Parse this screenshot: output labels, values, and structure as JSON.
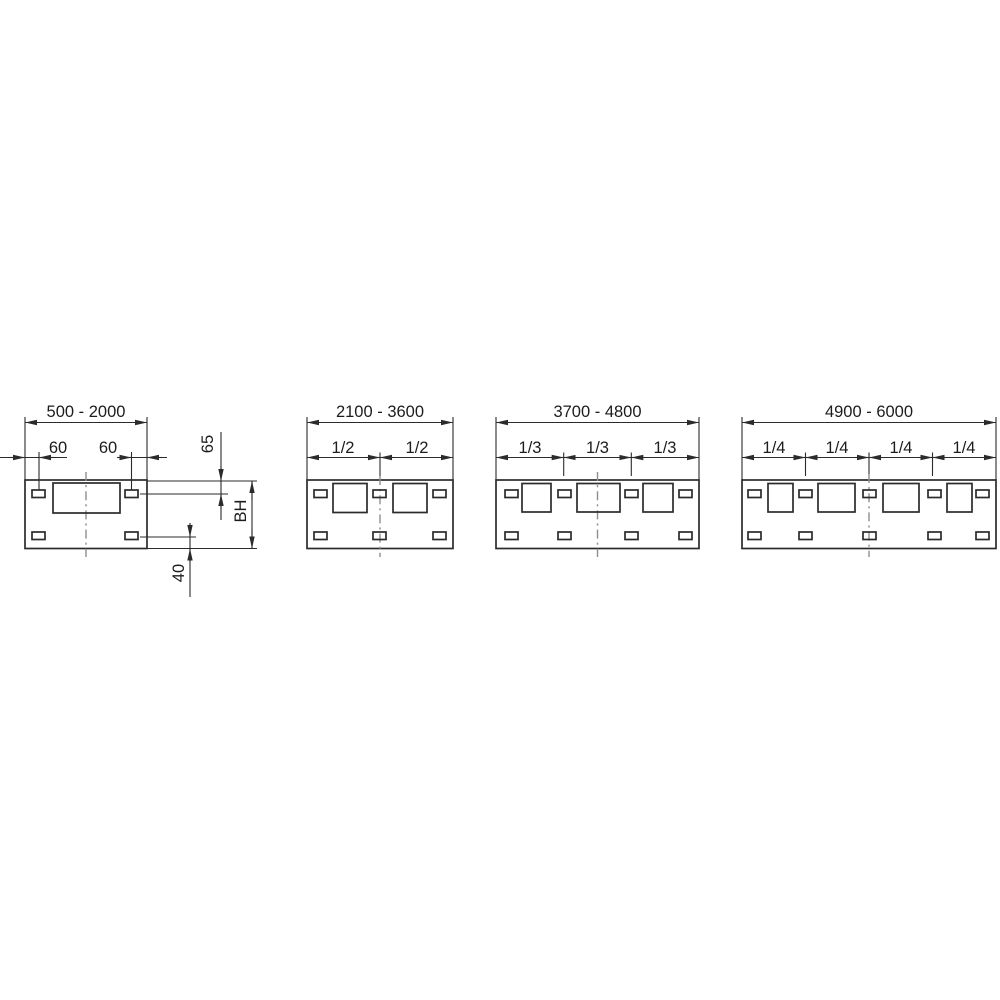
{
  "diagram": {
    "colors": {
      "line": "#2b2b2b",
      "centerline": "#8f8f8f",
      "background": "#ffffff"
    },
    "panels": [
      {
        "range": "500 - 2000",
        "left_hole_offset": "60",
        "right_hole_offset": "60",
        "top_hole_offset": "65",
        "body_height": "BH",
        "bottom_hole_offset": "40",
        "fractions": []
      },
      {
        "range": "2100 - 3600",
        "fractions": [
          "1/2",
          "1/2"
        ]
      },
      {
        "range": "3700 - 4800",
        "fractions": [
          "1/3",
          "1/3",
          "1/3"
        ]
      },
      {
        "range": "4900 - 6000",
        "fractions": [
          "1/4",
          "1/4",
          "1/4",
          "1/4"
        ]
      }
    ]
  }
}
